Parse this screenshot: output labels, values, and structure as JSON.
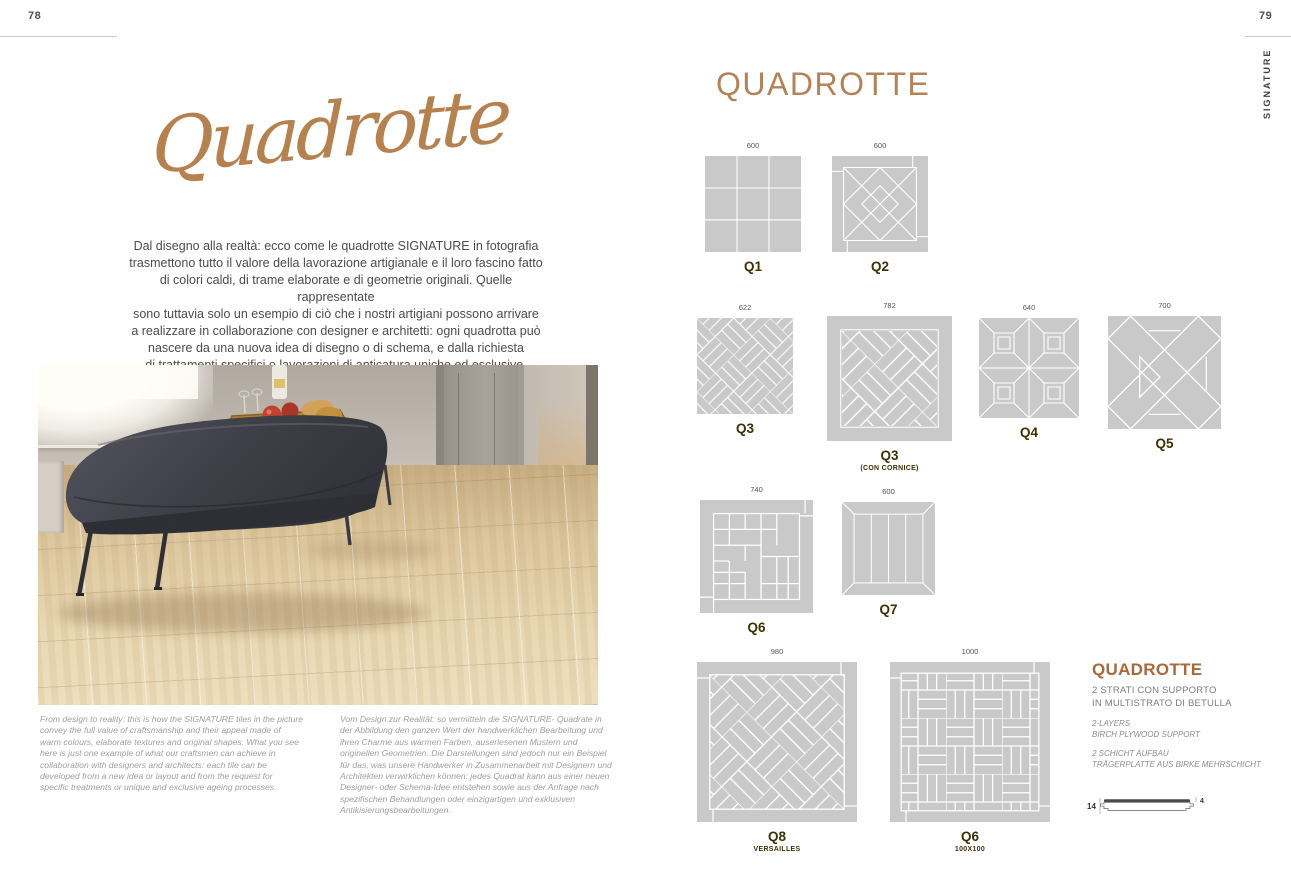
{
  "left_page": {
    "page_number": "78",
    "title_script": "Quadrotte",
    "intro_lines": [
      "Dal disegno alla realtà: ecco come le quadrotte SIGNATURE in fotografia",
      "trasmettono tutto il valore della lavorazione artigianale e il loro fascino fatto",
      "di colori caldi, di trame elaborate e di geometrie originali. Quelle rappresentate",
      "sono tuttavia solo un esempio di ciò che i nostri artigiani possono arrivare",
      "a realizzare in collaborazione con designer e architetti: ogni quadrotta può",
      "nascere da una nuova idea di disegno o di schema, e dalla richiesta",
      "di trattamenti specifici o lavorazioni di anticatura uniche ed esclusive."
    ],
    "caption_english": "From design to reality: this is how the SIGNATURE tiles in the picture convey the full value of craftsmanship and their appeal made of warm colours, elaborate textures and original shapes. What you see here is just one example of what our craftsmen can achieve in collaboration with designers and architects: each tile can be developed from a new idea or layout and from the request for specific treatments or unique and exclusive ageing processes.",
    "caption_german": "Vom Design zur Realität: so vermitteln die SIGNATURE- Quadrate in der Abbildung den ganzen Wert der handwerklichen Bearbeitung und ihren Charme aus warmen Farben, auserlesenen Mustern und originellen Geometrien. Die Darstellungen sind jedoch nur ein Beispiel für das, was unsere Handwerker in Zusammenarbeit mit Designern und Architekten verwirklichen können: jedes Quadrat kann aus einer neuen Designer- oder Schema-Idee entstehen sowie aus der Anfrage nach spezifischen Behandlungen oder einzigartigen und exklusiven Antikisierungsbearbeitungen."
  },
  "right_page": {
    "page_number": "79",
    "sidebar_label": "SIGNATURE",
    "header": "QUADROTTE",
    "tiles": [
      {
        "dim": "600",
        "label": "Q1",
        "sublabel": ""
      },
      {
        "dim": "600",
        "label": "Q2",
        "sublabel": ""
      },
      {
        "dim": "622",
        "label": "Q3",
        "sublabel": ""
      },
      {
        "dim": "782",
        "label": "Q3",
        "sublabel": "(CON CORNICE)"
      },
      {
        "dim": "640",
        "label": "Q4",
        "sublabel": ""
      },
      {
        "dim": "700",
        "label": "Q5",
        "sublabel": ""
      },
      {
        "dim": "740",
        "label": "Q6",
        "sublabel": ""
      },
      {
        "dim": "600",
        "label": "Q7",
        "sublabel": ""
      },
      {
        "dim": "980",
        "label": "Q8",
        "sublabel": "VERSAILLES"
      },
      {
        "dim": "1000",
        "label": "Q6",
        "sublabel": "100X100"
      }
    ],
    "info": {
      "heading": "QUADROTTE",
      "italian_lines": [
        "2 STRATI CON SUPPORTO",
        "IN MULTISTRATO DI BETULLA"
      ],
      "english_lines": [
        "2-LAYERS",
        "BIRCH PLYWOOD SUPPORT"
      ],
      "german_lines": [
        "2 SCHICHT AUFBAU",
        "TRÄGERPLATTE AUS BIRKE MEHRSCHICHT"
      ],
      "profile": {
        "total_thickness": "14",
        "top_layer": "4"
      }
    }
  },
  "colors": {
    "accent_script": "#b5814f",
    "accent_header": "#b28258",
    "accent_info_heading": "#a8683c",
    "tile_label_dark": "#3a3105",
    "tile_grey": "#c9c9c9",
    "body_text_grey": "#4b4b4b",
    "caption_grey": "#9e9e9e"
  }
}
